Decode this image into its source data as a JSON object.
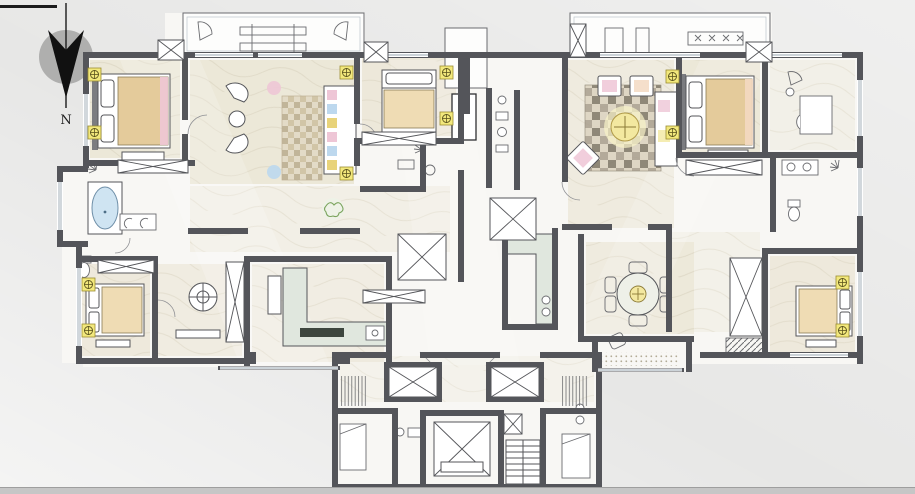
{
  "title": "residential-floor-plan",
  "compass": {
    "label": "N"
  },
  "palette": {
    "background_left": "#e7e7e6",
    "background_right": "#f1f1f0",
    "bottom_bar": "#c6c6c6",
    "wall": "#54555a",
    "wall_light": "#8c8d90",
    "floor": "#f8f7f4",
    "wash": "#e9e3d1",
    "window": "#9aa7b2",
    "light_fixture": "#f2e87c",
    "wood": "#e4cb9b",
    "wood_light": "#efdcb4",
    "tub_blue": "#cfe4f2",
    "counter_green": "#e0e7de",
    "counter_dark": "#3d463e",
    "rug_base": "#dcd3c0",
    "rug_dark": "#6f6757",
    "accent_pink": "#eec6d6",
    "accent_blue": "#bdd8ee",
    "accent_yellow": "#e8d37a",
    "plant_green": "#7ba45e",
    "table_yellow": "#f3e8a0"
  },
  "icons": [
    "north-arrow-icon",
    "ceiling-light-icon",
    "bed-icon",
    "sofa-icon",
    "bathtub-icon",
    "shower-icon",
    "toilet-icon",
    "sink-icon",
    "kitchen-counter-icon",
    "stove-icon",
    "dining-table-icon",
    "tea-table-icon",
    "armchair-icon",
    "plant-icon",
    "elevator-icon",
    "duct-shaft-icon",
    "stairs-icon",
    "wardrobe-icon",
    "drying-rack-icon",
    "balcony-railing-icon",
    "rug-icon"
  ]
}
